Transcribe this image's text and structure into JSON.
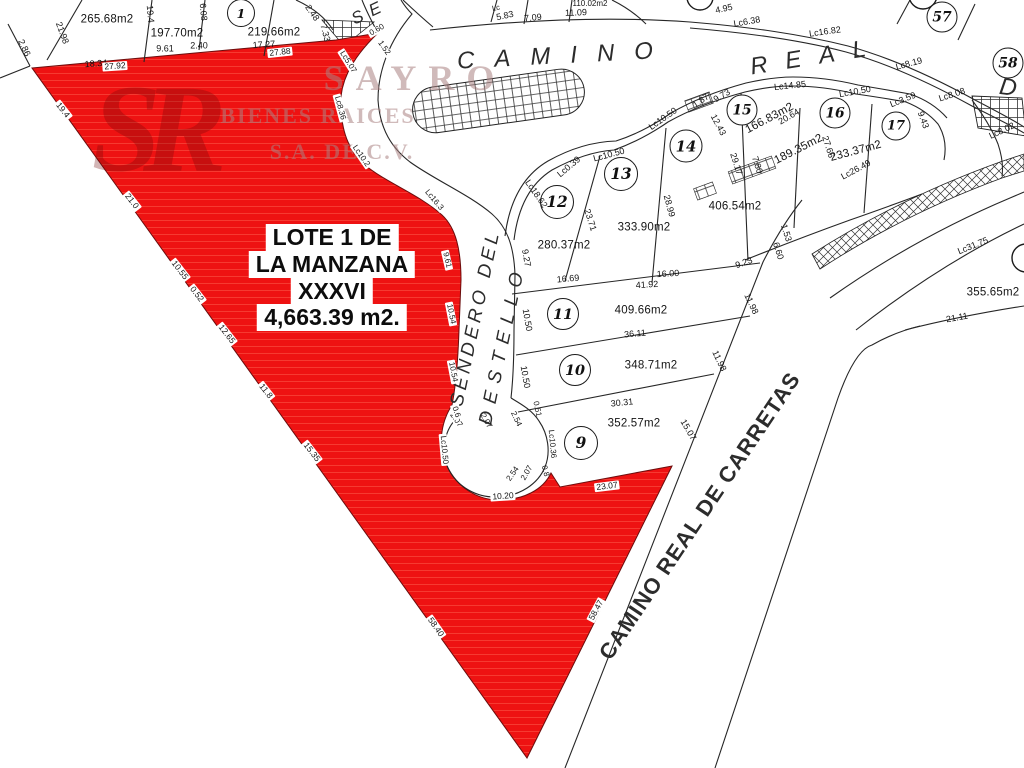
{
  "map_title": "Plano de lotificación",
  "watermark": {
    "logo": "SR",
    "logo_x": 150,
    "logo_y": 130,
    "lines": [
      {
        "t": "SAYRO",
        "x": 415,
        "y": 78,
        "fs": 36,
        "ls": 12
      },
      {
        "t": "BIENES RAICES",
        "x": 318,
        "y": 116,
        "fs": 22,
        "ls": 2
      },
      {
        "t": "S.A. DE C.V.",
        "x": 342,
        "y": 152,
        "fs": 22,
        "ls": 2
      }
    ]
  },
  "highlight": {
    "color": "#ee1212",
    "x": 332,
    "y": 224,
    "line_h": 27,
    "lines": [
      "LOTE 1 DE",
      "LA MANZANA",
      "XXXVI",
      "4,663.39 m2."
    ]
  },
  "streets": [
    {
      "id": "camino-real-1",
      "t": "CAMINO",
      "x": 565,
      "y": 56,
      "r": -3,
      "fs": 24,
      "ls": 20,
      "it": 1,
      "w": 400
    },
    {
      "id": "camino-real-2",
      "t": "REAL",
      "x": 817,
      "y": 57,
      "r": -9,
      "fs": 24,
      "ls": 18,
      "it": 1,
      "w": 400
    },
    {
      "id": "street-se",
      "t": "SE",
      "x": 370,
      "y": 12,
      "r": -25,
      "fs": 17,
      "ls": 8,
      "it": 1,
      "w": 400
    },
    {
      "id": "street-d",
      "t": "D",
      "x": 1008,
      "y": 88,
      "r": 8,
      "fs": 24,
      "ls": 0,
      "it": 1,
      "w": 400
    },
    {
      "id": "sendero-line-1",
      "t": "SENDERO DEL",
      "x": 476,
      "y": 318,
      "r": -78,
      "fs": 19,
      "ls": 4,
      "it": 1,
      "w": 400
    },
    {
      "id": "sendero-line-2",
      "t": "DESTELLO",
      "x": 503,
      "y": 345,
      "r": -78,
      "fs": 19,
      "ls": 8,
      "it": 1,
      "w": 400
    },
    {
      "id": "camino-real-de-carretas",
      "t": "CAMINO REAL DE CARRETAS",
      "x": 700,
      "y": 516,
      "r": -56,
      "fs": 22,
      "ls": 1,
      "it": 0,
      "w": 600
    }
  ],
  "lot_numbers": [
    {
      "n": "1",
      "x": 241,
      "y": 13,
      "d": 26
    },
    {
      "n": "9",
      "x": 581,
      "y": 443,
      "d": 32
    },
    {
      "n": "10",
      "x": 575,
      "y": 370,
      "d": 30
    },
    {
      "n": "11",
      "x": 563,
      "y": 314,
      "d": 30
    },
    {
      "n": "12",
      "x": 557,
      "y": 202,
      "d": 32
    },
    {
      "n": "13",
      "x": 621,
      "y": 174,
      "d": 32
    },
    {
      "n": "14",
      "x": 686,
      "y": 146,
      "d": 31
    },
    {
      "n": "15",
      "x": 742,
      "y": 110,
      "d": 29
    },
    {
      "n": "16",
      "x": 835,
      "y": 113,
      "d": 29
    },
    {
      "n": "17",
      "x": 896,
      "y": 126,
      "d": 27
    },
    {
      "n": "57",
      "x": 942,
      "y": 17,
      "d": 29
    },
    {
      "n": "58",
      "x": 1008,
      "y": 63,
      "d": 29
    }
  ],
  "labels": [
    {
      "t": "265.68m2",
      "x": 107,
      "y": 20,
      "r": 0,
      "k": "area"
    },
    {
      "t": "197.70m2",
      "x": 177,
      "y": 34,
      "r": 0,
      "k": "area"
    },
    {
      "t": "219.66m2",
      "x": 274,
      "y": 33,
      "r": 0,
      "k": "area"
    },
    {
      "t": "110.02m2",
      "x": 590,
      "y": 4,
      "r": 0,
      "k": "dim",
      "fs": 8
    },
    {
      "t": "166.83m2",
      "x": 770,
      "y": 119,
      "r": -28,
      "k": "area"
    },
    {
      "t": "189.35m2",
      "x": 799,
      "y": 150,
      "r": -27,
      "k": "area"
    },
    {
      "t": "233.37m2",
      "x": 856,
      "y": 152,
      "r": -15,
      "k": "area"
    },
    {
      "t": "406.54m2",
      "x": 735,
      "y": 207,
      "r": 0,
      "k": "area"
    },
    {
      "t": "333.90m2",
      "x": 644,
      "y": 228,
      "r": 0,
      "k": "area"
    },
    {
      "t": "280.37m2",
      "x": 564,
      "y": 246,
      "r": 0,
      "k": "area"
    },
    {
      "t": "409.66m2",
      "x": 641,
      "y": 311,
      "r": 0,
      "k": "area"
    },
    {
      "t": "348.71m2",
      "x": 651,
      "y": 366,
      "r": 0,
      "k": "area"
    },
    {
      "t": "352.57m2",
      "x": 634,
      "y": 424,
      "r": 0,
      "k": "area"
    },
    {
      "t": "355.65m2",
      "x": 993,
      "y": 293,
      "r": 0,
      "k": "area"
    },
    {
      "t": "21.98",
      "x": 62,
      "y": 33,
      "r": 70,
      "k": "dim"
    },
    {
      "t": "2.86",
      "x": 24,
      "y": 48,
      "r": 65,
      "k": "dim"
    },
    {
      "t": "18.34",
      "x": 96,
      "y": 64,
      "r": -4,
      "k": "dim"
    },
    {
      "t": "19.4",
      "x": 150,
      "y": 14,
      "r": 85,
      "k": "dim"
    },
    {
      "t": "9.61",
      "x": 165,
      "y": 49,
      "r": 0,
      "k": "dim"
    },
    {
      "t": "2.40",
      "x": 199,
      "y": 46,
      "r": 0,
      "k": "dim"
    },
    {
      "t": "6.08",
      "x": 203,
      "y": 12,
      "r": 85,
      "k": "dim"
    },
    {
      "t": "17.27",
      "x": 264,
      "y": 45,
      "r": -4,
      "k": "dim"
    },
    {
      "t": "2.48",
      "x": 312,
      "y": 13,
      "r": 55,
      "k": "dim"
    },
    {
      "t": "7.33",
      "x": 325,
      "y": 33,
      "r": 75,
      "k": "dim"
    },
    {
      "t": "5.83",
      "x": 505,
      "y": 16,
      "r": -12,
      "k": "dim"
    },
    {
      "t": "Lc",
      "x": 496,
      "y": 8,
      "r": -12,
      "k": "dim",
      "fs": 7.5
    },
    {
      "t": "7.09",
      "x": 533,
      "y": 18,
      "r": -6,
      "k": "dim"
    },
    {
      "t": "11.09",
      "x": 576,
      "y": 13,
      "r": -2,
      "k": "dim"
    },
    {
      "t": "4.95",
      "x": 724,
      "y": 9,
      "r": -12,
      "k": "dim"
    },
    {
      "t": "Lc6.38",
      "x": 747,
      "y": 22,
      "r": -10,
      "k": "dim"
    },
    {
      "t": "Lc16.82",
      "x": 825,
      "y": 32,
      "r": -8,
      "k": "dim"
    },
    {
      "t": "Lc8.19",
      "x": 909,
      "y": 64,
      "r": -15,
      "k": "dim"
    },
    {
      "t": "Lc8.08",
      "x": 952,
      "y": 95,
      "r": -18,
      "k": "dim"
    },
    {
      "t": "Lc8.02",
      "x": 1002,
      "y": 131,
      "r": -25,
      "k": "dim"
    },
    {
      "t": "Lc14.85",
      "x": 790,
      "y": 86,
      "r": -6,
      "k": "dim"
    },
    {
      "t": "Lc10.50",
      "x": 855,
      "y": 92,
      "r": -10,
      "k": "dim"
    },
    {
      "t": "Lc3.59",
      "x": 903,
      "y": 100,
      "r": -22,
      "k": "dim"
    },
    {
      "t": "1.87",
      "x": 701,
      "y": 101,
      "r": -35,
      "k": "dim"
    },
    {
      "t": "9.73",
      "x": 722,
      "y": 96,
      "r": -30,
      "k": "dim"
    },
    {
      "t": "12.43",
      "x": 718,
      "y": 125,
      "r": 62,
      "k": "dim"
    },
    {
      "t": "20.64",
      "x": 789,
      "y": 117,
      "r": -30,
      "k": "dim"
    },
    {
      "t": "Lc10.50",
      "x": 663,
      "y": 119,
      "r": -35,
      "k": "dim"
    },
    {
      "t": "Lc10.50",
      "x": 609,
      "y": 155,
      "r": -15,
      "k": "dim"
    },
    {
      "t": "Lc0.39",
      "x": 569,
      "y": 167,
      "r": -40,
      "k": "dim"
    },
    {
      "t": "Lc18.62",
      "x": 536,
      "y": 194,
      "r": 55,
      "k": "dim"
    },
    {
      "t": "23.71",
      "x": 590,
      "y": 220,
      "r": 72,
      "k": "dim"
    },
    {
      "t": "28.99",
      "x": 669,
      "y": 206,
      "r": 75,
      "k": "dim"
    },
    {
      "t": "29.17",
      "x": 736,
      "y": 164,
      "r": 72,
      "k": "dim"
    },
    {
      "t": "7.80",
      "x": 757,
      "y": 165,
      "r": 72,
      "k": "dim"
    },
    {
      "t": "27.66",
      "x": 828,
      "y": 147,
      "r": 72,
      "k": "dim"
    },
    {
      "t": "Lc26.49",
      "x": 856,
      "y": 170,
      "r": -28,
      "k": "dim"
    },
    {
      "t": "9.43",
      "x": 923,
      "y": 120,
      "r": 70,
      "k": "dim"
    },
    {
      "t": "9.27",
      "x": 526,
      "y": 258,
      "r": 80,
      "k": "dim"
    },
    {
      "t": "16.69",
      "x": 568,
      "y": 279,
      "r": -5,
      "k": "dim"
    },
    {
      "t": "16.00",
      "x": 668,
      "y": 274,
      "r": -3,
      "k": "dim"
    },
    {
      "t": "41.92",
      "x": 647,
      "y": 285,
      "r": -3,
      "k": "dim"
    },
    {
      "t": "9.23",
      "x": 744,
      "y": 263,
      "r": -20,
      "k": "dim"
    },
    {
      "t": "6.60",
      "x": 778,
      "y": 251,
      "r": 72,
      "k": "dim"
    },
    {
      "t": "1.53",
      "x": 786,
      "y": 233,
      "r": 72,
      "k": "dim"
    },
    {
      "t": "10.50",
      "x": 527,
      "y": 320,
      "r": 80,
      "k": "dim"
    },
    {
      "t": "36.11",
      "x": 635,
      "y": 334,
      "r": -5,
      "k": "dim"
    },
    {
      "t": "11.98",
      "x": 751,
      "y": 304,
      "r": 65,
      "k": "dim"
    },
    {
      "t": "11.98",
      "x": 719,
      "y": 361,
      "r": 65,
      "k": "dim"
    },
    {
      "t": "10.50",
      "x": 525,
      "y": 377,
      "r": 80,
      "k": "dim"
    },
    {
      "t": "30.31",
      "x": 622,
      "y": 403,
      "r": -6,
      "k": "dim"
    },
    {
      "t": "15.07",
      "x": 688,
      "y": 430,
      "r": 60,
      "k": "dim"
    },
    {
      "t": "Lc31.75",
      "x": 973,
      "y": 246,
      "r": -22,
      "k": "dim"
    },
    {
      "t": "21.11",
      "x": 957,
      "y": 318,
      "r": -10,
      "k": "dim"
    },
    {
      "t": "2.07",
      "x": 486,
      "y": 421,
      "r": 60,
      "k": "dim",
      "fs": 8
    },
    {
      "t": "2.54",
      "x": 516,
      "y": 419,
      "r": 65,
      "k": "dim",
      "fs": 8
    },
    {
      "t": "0.51",
      "x": 537,
      "y": 409,
      "r": 78,
      "k": "dim",
      "fs": 8
    },
    {
      "t": "Lc10.36",
      "x": 552,
      "y": 444,
      "r": 85,
      "k": "dim",
      "fs": 8
    },
    {
      "t": "0.8",
      "x": 545,
      "y": 471,
      "r": 75,
      "k": "dim",
      "fs": 8
    },
    {
      "t": "2.07",
      "x": 527,
      "y": 473,
      "r": -60,
      "k": "dim",
      "fs": 8
    },
    {
      "t": "2.54",
      "x": 513,
      "y": 474,
      "r": -55,
      "k": "dim",
      "fs": 8
    },
    {
      "t": "Lc10.50",
      "x": 444,
      "y": 450,
      "r": 85,
      "k": "chip",
      "fs": 8
    },
    {
      "t": "2.07",
      "x": 456,
      "y": 420,
      "r": 55,
      "k": "chip",
      "fs": 8
    },
    {
      "t": "27.92",
      "x": 115,
      "y": 66,
      "r": -4,
      "k": "chip"
    },
    {
      "t": "27.88",
      "x": 280,
      "y": 52,
      "r": -6,
      "k": "chip"
    },
    {
      "t": "19.4",
      "x": 63,
      "y": 110,
      "r": 52,
      "k": "chip"
    },
    {
      "t": "21.0",
      "x": 132,
      "y": 201,
      "r": 52,
      "k": "chip"
    },
    {
      "t": "10.55",
      "x": 180,
      "y": 270,
      "r": 52,
      "k": "chip"
    },
    {
      "t": "0.52",
      "x": 197,
      "y": 294,
      "r": 52,
      "k": "chip"
    },
    {
      "t": "12.65",
      "x": 227,
      "y": 334,
      "r": 52,
      "k": "chip"
    },
    {
      "t": "11.8",
      "x": 266,
      "y": 391,
      "r": 52,
      "k": "chip"
    },
    {
      "t": "15.35",
      "x": 312,
      "y": 452,
      "r": 52,
      "k": "chip"
    },
    {
      "t": "58.40",
      "x": 436,
      "y": 627,
      "r": 55,
      "k": "chip"
    },
    {
      "t": "58.47",
      "x": 596,
      "y": 610,
      "r": -62,
      "k": "chip"
    },
    {
      "t": "23.07",
      "x": 607,
      "y": 486,
      "r": -7,
      "k": "chip"
    },
    {
      "t": "10.20",
      "x": 503,
      "y": 496,
      "r": -4,
      "k": "chip"
    },
    {
      "t": "0.60",
      "x": 377,
      "y": 30,
      "r": -30,
      "k": "chip",
      "fs": 8
    },
    {
      "t": "1.52",
      "x": 384,
      "y": 48,
      "r": 55,
      "k": "chip",
      "fs": 8
    },
    {
      "t": "Lc5.07",
      "x": 348,
      "y": 62,
      "r": 58,
      "k": "chip",
      "fs": 8
    },
    {
      "t": "Lc8.36",
      "x": 340,
      "y": 108,
      "r": 75,
      "k": "chip",
      "fs": 8
    },
    {
      "t": "Lc10.2",
      "x": 361,
      "y": 156,
      "r": 55,
      "k": "chip",
      "fs": 8
    },
    {
      "t": "Lc16.3",
      "x": 434,
      "y": 200,
      "r": 50,
      "k": "chip",
      "fs": 8
    },
    {
      "t": "9.61",
      "x": 447,
      "y": 260,
      "r": 77,
      "k": "chip",
      "fs": 8
    },
    {
      "t": "10.54",
      "x": 451,
      "y": 314,
      "r": 79,
      "k": "chip",
      "fs": 8
    },
    {
      "t": "10.54",
      "x": 453,
      "y": 372,
      "r": 79,
      "k": "chip",
      "fs": 8
    },
    {
      "t": "0.6",
      "x": 456,
      "y": 412,
      "r": 72,
      "k": "chip",
      "fs": 8
    }
  ]
}
